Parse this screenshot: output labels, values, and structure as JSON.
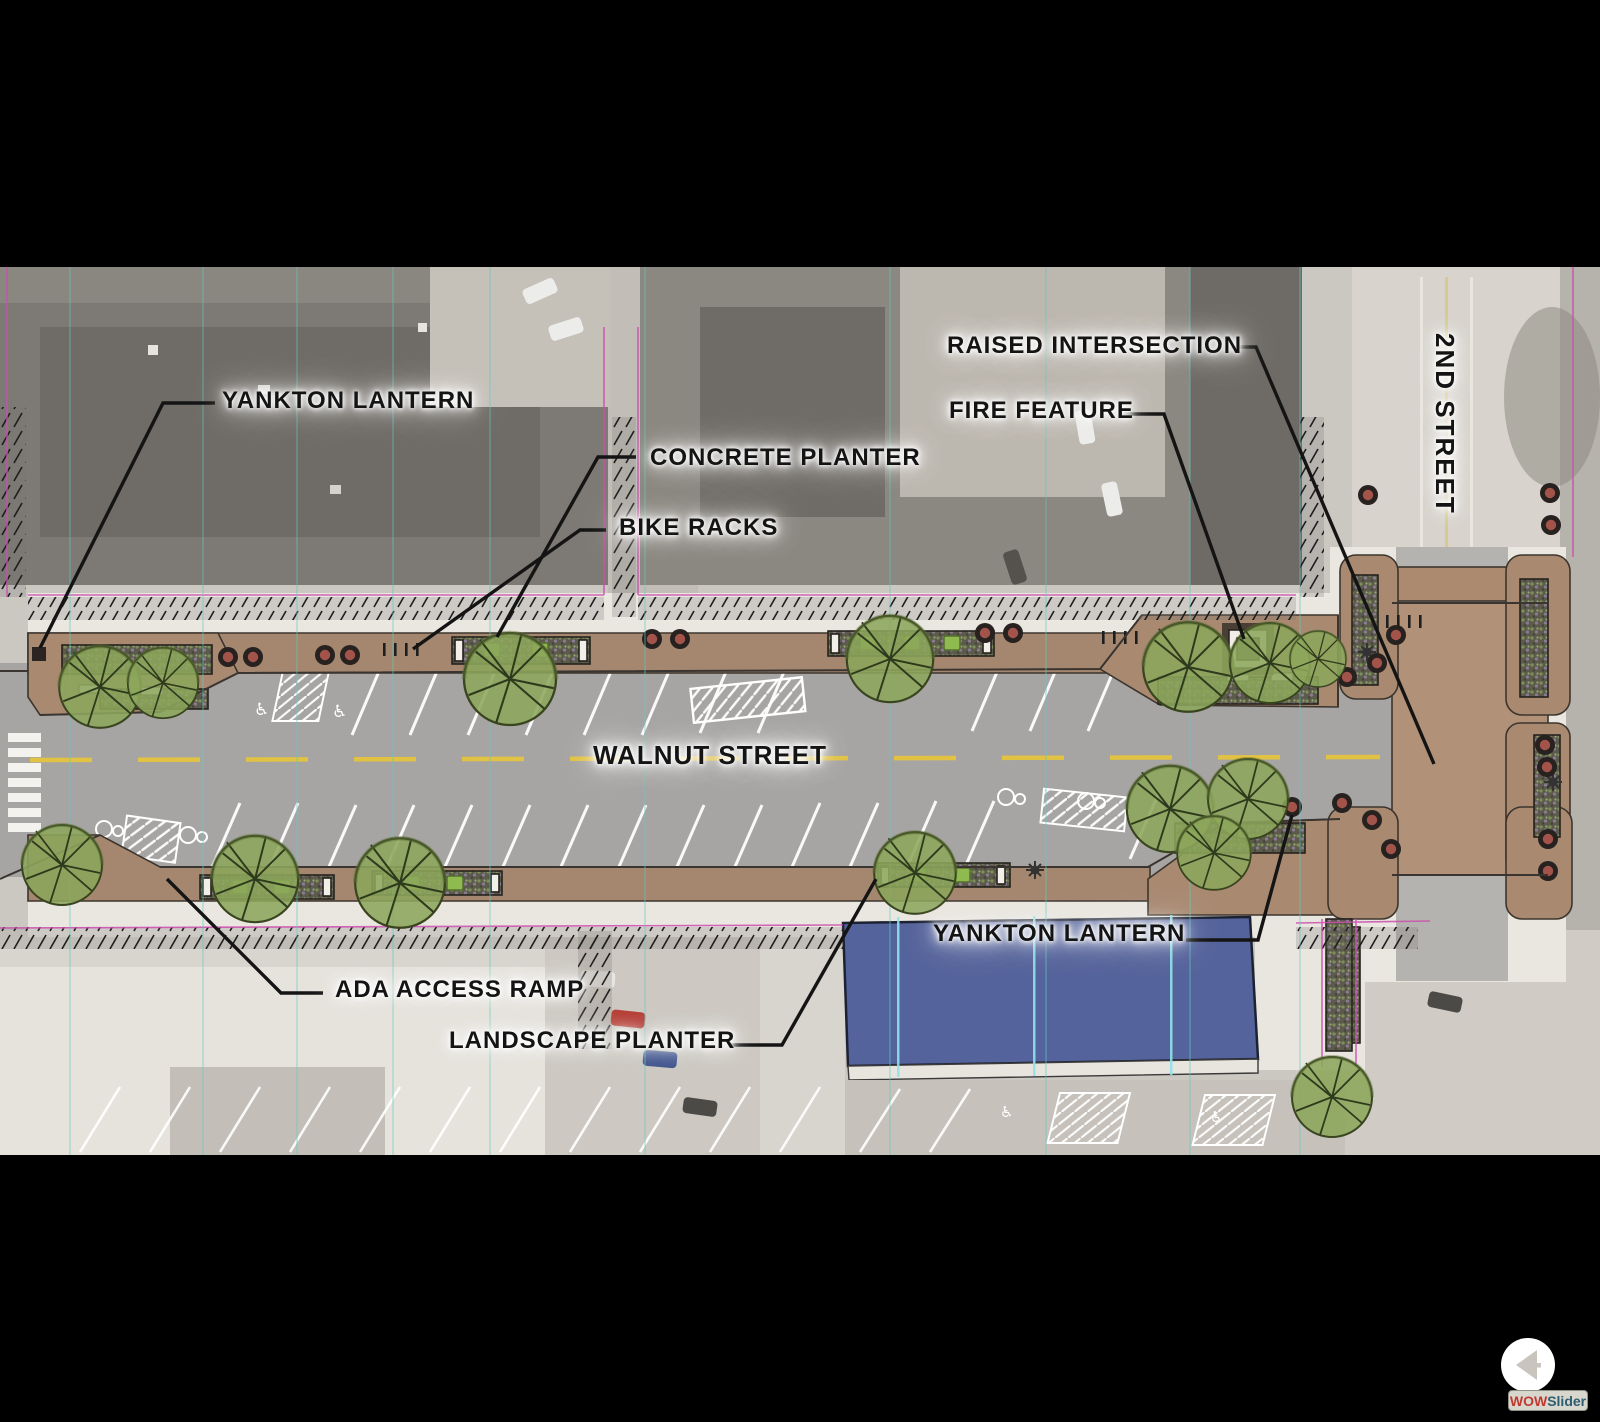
{
  "labels": {
    "yankton_lantern_top": "YANKTON LANTERN",
    "concrete_planter": "CONCRETE PLANTER",
    "bike_racks": "BIKE RACKS",
    "raised_intersection": "RAISED INTERSECTION",
    "fire_feature": "FIRE FEATURE",
    "walnut_street": "WALNUT STREET",
    "second_street": "2ND STREET",
    "yankton_lantern_bottom": "YANKTON LANTERN",
    "ada_access_ramp": "ADA ACCESS RAMP",
    "landscape_planter": "LANDSCAPE PLANTER"
  },
  "watermark": {
    "brand_red": "WOW",
    "brand_blue": "Slider"
  },
  "colors": {
    "street_gray": "#a7a5a3",
    "sidewalk_white": "#eae7e1",
    "paver_brown": "#a5876f",
    "intersection_brown": "#b29179",
    "building_blue": "#55639c",
    "tree_green": "#8ca65b",
    "centerline_yellow": "#e2c243",
    "gridline_teal": "#63c9c2",
    "property_magenta": "#cc4fae",
    "label_text": "#141414"
  }
}
